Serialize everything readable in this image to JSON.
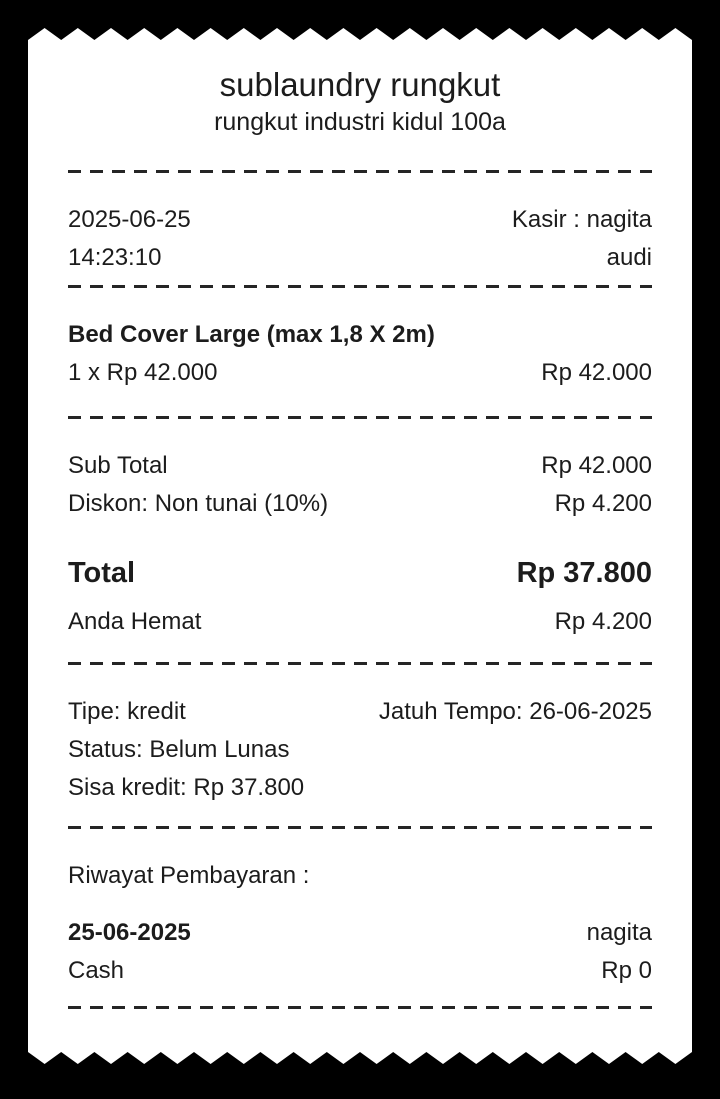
{
  "colors": {
    "background": "#000000",
    "paper": "#ffffff",
    "text": "#1c1c1c"
  },
  "header": {
    "store_name": "sublaundry rungkut",
    "address": "rungkut industri kidul 100a"
  },
  "transaction": {
    "date": "2025-06-25",
    "time": "14:23:10",
    "cashier": "Kasir : nagita",
    "cashier_second_line": "audi"
  },
  "items": [
    {
      "name": "Bed Cover Large (max 1,8 X 2m)",
      "qty_price": "1 x Rp 42.000",
      "amount": "Rp 42.000"
    }
  ],
  "summary": {
    "subtotal_label": "Sub Total",
    "subtotal_value": "Rp 42.000",
    "discount_label": "Diskon: Non tunai (10%)",
    "discount_value": "Rp 4.200",
    "total_label": "Total",
    "total_value": "Rp 37.800",
    "savings_label": "Anda Hemat",
    "savings_value": "Rp 4.200"
  },
  "credit": {
    "type": "Tipe: kredit",
    "due_date": "Jatuh Tempo: 26-06-2025",
    "status": "Status: Belum Lunas",
    "remaining": "Sisa kredit: Rp 37.800"
  },
  "payment_history": {
    "title": "Riwayat Pembayaran :",
    "entries": [
      {
        "date": "25-06-2025",
        "by": "nagita",
        "method": "Cash",
        "amount": "Rp 0"
      }
    ]
  }
}
